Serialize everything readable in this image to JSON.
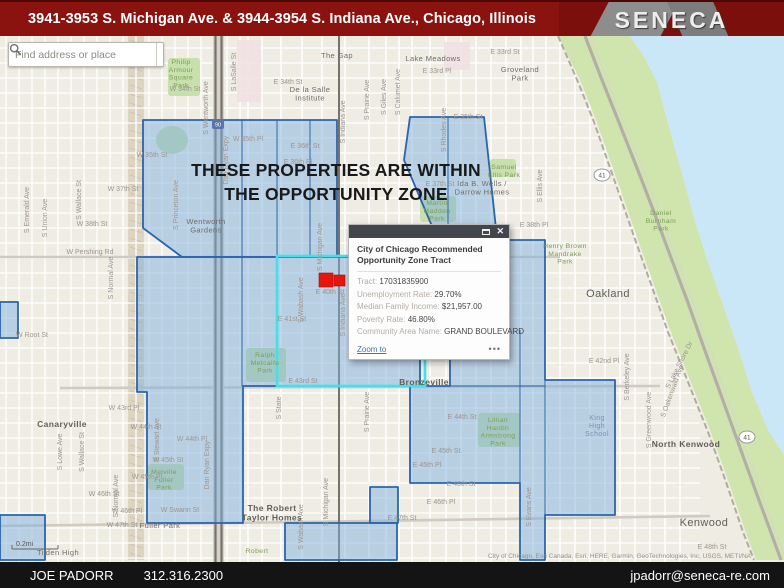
{
  "header": {
    "title": "3941-3953 S. Michigan Ave. & 3944-3954 S. Indiana Ave., Chicago, Illinois",
    "logo_text": "SENECA"
  },
  "search": {
    "placeholder": "Find address or place"
  },
  "overlay": {
    "line1": "THESE PROPERTIES ARE WITHIN",
    "line2": "THE OPPORTUNITY ZONE"
  },
  "popup": {
    "title": "City of Chicago Recommended Opportunity Zone Tract",
    "fields": [
      {
        "label": "Tract:",
        "value": "17031835900"
      },
      {
        "label": "Unemployment Rate:",
        "value": "29.70%"
      },
      {
        "label": "Median Family Income:",
        "value": "$21,957.00"
      },
      {
        "label": "Poverty Rate:",
        "value": "46.80%"
      },
      {
        "label": "Community Area Name:",
        "value": "GRAND BOULEVARD"
      }
    ],
    "zoom_link": "Zoom to",
    "more": "•••"
  },
  "footer": {
    "name": "JOE PADORR",
    "phone": "312.316.2300",
    "email": "jpadorr@seneca-re.com"
  },
  "map": {
    "colors": {
      "base": "#efece4",
      "water": "#cae7f8",
      "green": "#cfe5ad",
      "park": "#c8e0ab",
      "zone_fill": "#7badde",
      "zone_stroke": "#2a64ad",
      "selected": "#3fe2ec",
      "marker": "#e8150d",
      "minor_street": "#ffffff",
      "major_street": "#cfcbc3",
      "rail": "#77736b",
      "pink_block": "#f0dfe2",
      "rail_yard": "#ddd5c2"
    },
    "scale_text": "0.2mi",
    "attribution": "City of Chicago, Esri Canada, Esri, HERE, Garmin, GeoTechnologies, Inc, USGS, METI/NA",
    "water_poly": "630,36 784,36 784,455 768,430 752,392 738,348 722,302 708,262 697,228 686,188 676,152 665,112 657,82 645,58",
    "green_poly": "558,36 580,80 596,120 610,160 624,200 638,240 654,285 670,330 690,380 710,430 728,480 745,530 756,560 784,560 784,455 768,430 752,392 738,348 722,302 708,262 697,228 686,188 676,152 665,112 657,82 645,58 630,36",
    "lsd_path": "M585,36 L602,80 L620,125 L637,168 L654,212 L670,255 L687,300 L704,348 L721,395 L739,445 L756,492 L770,530 L781,560",
    "shore_rail_path": "M558,36 L578,82 L594,122 L608,162 L622,202 L636,242 L652,287 L668,332 L688,382 L708,432 L726,482 L743,532 L754,560",
    "zones": [
      "143,120 337,120 337,257 182,257 143,228",
      "410,117 484,117 497,238 437,238 404,160",
      "137,257 420,257 420,386 243,386 243,523 147,523 147,392 137,392",
      "497,240 545,240 545,380 615,380 615,515 545,515 545,560 520,560 520,483 410,483 410,386 450,386 450,330 497,330",
      "0,302 18,302 18,338 0,338",
      "0,515 45,515 45,560 0,560",
      "370,487 398,487 398,523 370,523",
      "285,523 397,523 397,560 285,560"
    ],
    "zone_inner_lines": [
      [
        242,
        120,
        242,
        257
      ],
      [
        277,
        120,
        277,
        257
      ],
      [
        310,
        120,
        310,
        257
      ],
      [
        448,
        117,
        448,
        238
      ],
      [
        242,
        257,
        242,
        386
      ],
      [
        545,
        380,
        545,
        515
      ],
      [
        450,
        386,
        545,
        386
      ],
      [
        520,
        330,
        520,
        483
      ]
    ],
    "selected_tract": {
      "x": 277,
      "y": 256,
      "w": 148,
      "h": 130
    },
    "markers": [
      {
        "x": 319,
        "y": 273,
        "w": 14,
        "h": 14
      },
      {
        "x": 334,
        "y": 275,
        "w": 11,
        "h": 11
      }
    ],
    "parks": [
      {
        "x": 168,
        "y": 58,
        "w": 32,
        "h": 38
      },
      {
        "x": 246,
        "y": 348,
        "w": 40,
        "h": 34
      },
      {
        "x": 148,
        "y": 464,
        "w": 36,
        "h": 26
      },
      {
        "x": 420,
        "y": 196,
        "w": 36,
        "h": 26
      },
      {
        "x": 490,
        "y": 159,
        "w": 26,
        "h": 18
      },
      {
        "x": 478,
        "y": 413,
        "w": 42,
        "h": 34
      }
    ],
    "park_ellipse": {
      "cx": 172,
      "cy": 140,
      "rx": 16,
      "ry": 14
    },
    "pink_blocks": [
      {
        "x": 237,
        "y": 40,
        "w": 24,
        "h": 62
      },
      {
        "x": 444,
        "y": 42,
        "w": 26,
        "h": 28
      }
    ],
    "rail_yard": {
      "x": 128,
      "y": 36,
      "w": 16,
      "h": 524
    },
    "grid": {
      "v_dense": {
        "from": 6,
        "to": 240,
        "step": 13
      },
      "v_list": [
        248,
        262,
        281,
        302,
        322,
        345,
        369,
        386,
        399,
        412,
        430,
        446,
        461,
        476,
        491,
        506,
        521,
        533,
        546,
        560,
        575,
        590,
        605,
        620,
        635,
        650,
        665,
        680
      ],
      "h": {
        "from": 48,
        "to": 558,
        "step": 15,
        "x1": 0,
        "x2": 700
      }
    },
    "majors": [
      "M0,257 L560,257",
      "M60,388 L660,386",
      "M0,526 L300,522 L710,516"
    ],
    "rails": [
      {
        "x": 215.5
      },
      {
        "x": 221.5
      },
      {
        "x": 339
      }
    ],
    "shields": [
      {
        "t": "41",
        "x": 602,
        "y": 175
      },
      {
        "t": "41",
        "x": 747,
        "y": 437
      }
    ],
    "i_shield": {
      "t": "90",
      "x": 218,
      "y": 124
    },
    "street_labels": [
      {
        "t": "E 33rd St",
        "x": 505,
        "y": 54
      },
      {
        "t": "E 33rd Pl",
        "x": 437,
        "y": 73
      },
      {
        "t": "W 34th St",
        "x": 185,
        "y": 91
      },
      {
        "t": "E 34th St",
        "x": 288,
        "y": 84
      },
      {
        "t": "W 35th St",
        "x": 152,
        "y": 157
      },
      {
        "t": "E 35th St",
        "x": 468,
        "y": 119
      },
      {
        "t": "W 35th Pl",
        "x": 248,
        "y": 141
      },
      {
        "t": "E 36th St",
        "x": 305,
        "y": 148
      },
      {
        "t": "E 36th Pl",
        "x": 298,
        "y": 164
      },
      {
        "t": "W 37th St",
        "x": 123,
        "y": 191
      },
      {
        "t": "E 37th St",
        "x": 440,
        "y": 186
      },
      {
        "t": "W 38th St",
        "x": 92,
        "y": 226
      },
      {
        "t": "E 38th Pl",
        "x": 534,
        "y": 227
      },
      {
        "t": "W Pershing Rd",
        "x": 90,
        "y": 254
      },
      {
        "t": "E 40th St",
        "x": 330,
        "y": 294
      },
      {
        "t": "E 41st St",
        "x": 292,
        "y": 321
      },
      {
        "t": "E 42nd St",
        "x": 434,
        "y": 351
      },
      {
        "t": "E 42nd Pl",
        "x": 604,
        "y": 363
      },
      {
        "t": "E 43rd St",
        "x": 303,
        "y": 383
      },
      {
        "t": "W 43rd Pl",
        "x": 124,
        "y": 410
      },
      {
        "t": "W 44th St",
        "x": 146,
        "y": 429
      },
      {
        "t": "E 44th St",
        "x": 462,
        "y": 419
      },
      {
        "t": "W 44th Pl",
        "x": 192,
        "y": 441
      },
      {
        "t": "E 45th St",
        "x": 446,
        "y": 453
      },
      {
        "t": "W 45th St",
        "x": 168,
        "y": 462
      },
      {
        "t": "E 45th Pl",
        "x": 427,
        "y": 467
      },
      {
        "t": "W 45th Pl",
        "x": 147,
        "y": 479
      },
      {
        "t": "E 46th St",
        "x": 461,
        "y": 486
      },
      {
        "t": "W 46th St",
        "x": 104,
        "y": 496
      },
      {
        "t": "E 46th Pl",
        "x": 441,
        "y": 504
      },
      {
        "t": "W 46th Pl",
        "x": 127,
        "y": 513
      },
      {
        "t": "W Swann St",
        "x": 180,
        "y": 512
      },
      {
        "t": "E 47th St",
        "x": 402,
        "y": 520
      },
      {
        "t": "W 47th St",
        "x": 122,
        "y": 527
      },
      {
        "t": "E 48th St",
        "x": 712,
        "y": 549
      },
      {
        "t": "W Root St",
        "x": 32,
        "y": 337
      },
      {
        "t": "S Emerald Ave",
        "x": 29,
        "y": 210,
        "r": -90
      },
      {
        "t": "S Union Ave",
        "x": 47,
        "y": 218,
        "r": -90
      },
      {
        "t": "S Wallace St",
        "x": 81,
        "y": 200,
        "r": -90
      },
      {
        "t": "S Wallace St",
        "x": 84,
        "y": 452,
        "r": -90
      },
      {
        "t": "S Lowe Ave",
        "x": 62,
        "y": 452,
        "r": -90
      },
      {
        "t": "S Normal Ave",
        "x": 113,
        "y": 278,
        "r": -90
      },
      {
        "t": "S Normal Ave",
        "x": 118,
        "y": 496,
        "r": -90
      },
      {
        "t": "S Princeton Ave",
        "x": 178,
        "y": 205,
        "r": -90
      },
      {
        "t": "S Wentworth Ave",
        "x": 208,
        "y": 108,
        "r": -90
      },
      {
        "t": "Dan Ryan Expy",
        "x": 228,
        "y": 160,
        "r": -90
      },
      {
        "t": "Dan Ryan Expy",
        "x": 209,
        "y": 465,
        "r": -90
      },
      {
        "t": "S LaSalle St",
        "x": 236,
        "y": 72,
        "r": -90
      },
      {
        "t": "S State",
        "x": 281,
        "y": 408,
        "r": -90
      },
      {
        "t": "S Wabash Ave",
        "x": 303,
        "y": 300,
        "r": -90
      },
      {
        "t": "S Wabash Ave",
        "x": 303,
        "y": 527,
        "r": -90
      },
      {
        "t": "S Michigan Ave",
        "x": 322,
        "y": 247,
        "r": -90
      },
      {
        "t": "S Michigan Ave",
        "x": 328,
        "y": 502,
        "r": -90
      },
      {
        "t": "S Indiana Ave",
        "x": 345,
        "y": 122,
        "r": -90
      },
      {
        "t": "S Indiana Ave",
        "x": 345,
        "y": 315,
        "r": -90
      },
      {
        "t": "S Prairie Ave",
        "x": 369,
        "y": 100,
        "r": -90
      },
      {
        "t": "S Prairie Ave",
        "x": 369,
        "y": 412,
        "r": -90
      },
      {
        "t": "S Giles Ave",
        "x": 386,
        "y": 97,
        "r": -90
      },
      {
        "t": "S Calumet Ave",
        "x": 400,
        "y": 92,
        "r": -90
      },
      {
        "t": "S Rhodes Ave",
        "x": 446,
        "y": 130,
        "r": -90
      },
      {
        "t": "S Stewart Ave",
        "x": 159,
        "y": 440,
        "r": -90
      },
      {
        "t": "S Evans Ave",
        "x": 531,
        "y": 507,
        "r": -90
      },
      {
        "t": "S Berkeley Ave",
        "x": 629,
        "y": 377,
        "r": -90
      },
      {
        "t": "S Greenwood Ave",
        "x": 651,
        "y": 420,
        "r": -90
      },
      {
        "t": "S Ellis Ave",
        "x": 542,
        "y": 186,
        "r": -90
      },
      {
        "t": "S Oakenwald Ave",
        "x": 674,
        "y": 392,
        "r": -70
      },
      {
        "t": "S Lake Shore Dr",
        "x": 681,
        "y": 366,
        "r": -63
      }
    ],
    "area_labels": [
      {
        "t": "The Gap",
        "x": 337,
        "y": 58,
        "cls": "nb"
      },
      {
        "t": "Lake Meadows",
        "x": 433,
        "y": 61,
        "cls": "nb"
      },
      {
        "t": "Groveland|Park",
        "x": 520,
        "y": 72,
        "cls": "nb"
      },
      {
        "t": "De la Salle|Institute",
        "x": 310,
        "y": 92,
        "cls": "nb"
      },
      {
        "t": "Wentworth|Gardens",
        "x": 206,
        "y": 224,
        "cls": "nb"
      },
      {
        "t": "Canaryville",
        "x": 62,
        "y": 427,
        "cls": "nbb"
      },
      {
        "t": "Bronzeville",
        "x": 424,
        "y": 385,
        "cls": "nbb"
      },
      {
        "t": "North Kenwood",
        "x": 686,
        "y": 447,
        "cls": "nbb"
      },
      {
        "t": "Kenwood",
        "x": 704,
        "y": 526,
        "cls": "nbl"
      },
      {
        "t": "Oakland",
        "x": 608,
        "y": 297,
        "cls": "nbl"
      },
      {
        "t": "Fuller Park",
        "x": 160,
        "y": 528,
        "cls": "nb"
      },
      {
        "t": "Tilden High",
        "x": 58,
        "y": 555,
        "cls": "nb"
      },
      {
        "t": "The Robert|Taylor Homes",
        "x": 272,
        "y": 511,
        "cls": "nbb"
      },
      {
        "t": "Ida B. Wells /|Darrow Homes",
        "x": 482,
        "y": 186,
        "cls": "nb"
      },
      {
        "t": "King|High|School",
        "x": 597,
        "y": 420,
        "cls": "sc"
      },
      {
        "t": "Philip|Armour|Square|Park",
        "x": 181,
        "y": 64,
        "cls": "pk"
      },
      {
        "t": "Ralph|Metcalfe|Park",
        "x": 265,
        "y": 357,
        "cls": "pk"
      },
      {
        "t": "Melville|Fuller|Park",
        "x": 164,
        "y": 474,
        "cls": "pk"
      },
      {
        "t": "Martin|Madden|Park",
        "x": 437,
        "y": 205,
        "cls": "pk"
      },
      {
        "t": "Samuel|Ellis Park",
        "x": 504,
        "y": 169,
        "cls": "pk"
      },
      {
        "t": "Lillian|Hardin|Armstrong|Park",
        "x": 498,
        "y": 422,
        "cls": "pk"
      },
      {
        "t": "Daniel|Burnham|Park",
        "x": 661,
        "y": 215,
        "cls": "pk"
      },
      {
        "t": "Henry Brown|Mandrake|Park",
        "x": 565,
        "y": 248,
        "cls": "pk"
      },
      {
        "t": "Robert",
        "x": 257,
        "y": 553,
        "cls": "pk"
      }
    ]
  }
}
